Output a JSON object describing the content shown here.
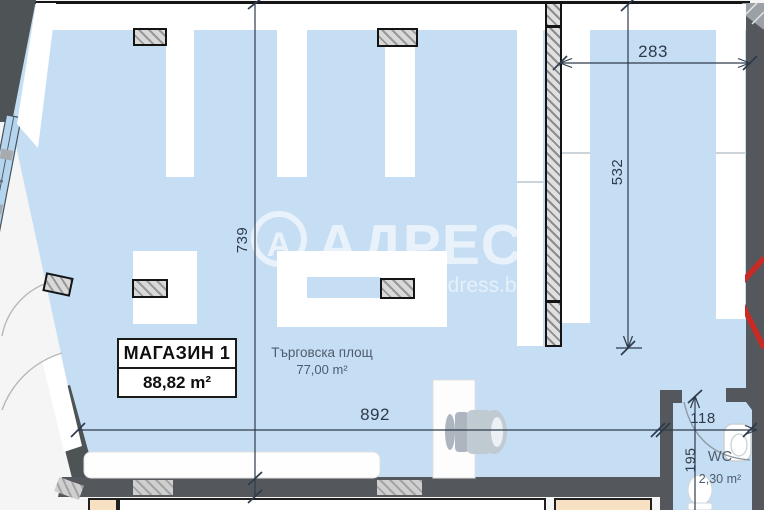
{
  "plan": {
    "unit_label": {
      "title": "МАГАЗИН 1",
      "area": "88,82 m²"
    },
    "trade_area": {
      "label": "Търговска площ",
      "area": "77,00 m²"
    },
    "wc": {
      "label": "WC",
      "area": "2,30 m²"
    },
    "dimensions": {
      "left_height": "739",
      "top_right_width": "283",
      "right_height": "532",
      "bottom_width": "892",
      "wc_door_width": "118",
      "wc_width": "195"
    },
    "watermark": {
      "logo_letter": "А",
      "brand": "АДРЕС",
      "site": "ddress.b"
    },
    "colors": {
      "floor_fill": "#c5def4",
      "wall_fill": "#54585c",
      "hatch_fill": "#d9d9d9",
      "beige_room": "#f8e0c2",
      "dimension_line": "#2e3b4a",
      "red_marker": "#cb2a24",
      "watermark_white": "#ffffff"
    }
  }
}
